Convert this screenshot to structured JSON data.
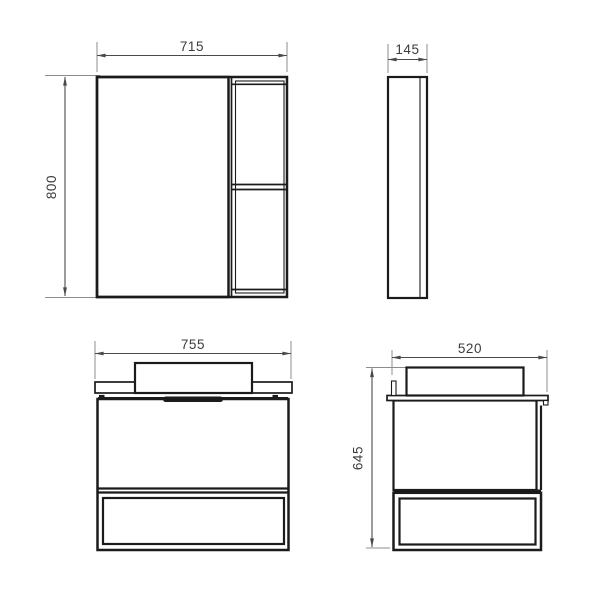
{
  "drawing": {
    "mirror_front": {
      "width": "715",
      "height": "800"
    },
    "mirror_side": {
      "depth": "145"
    },
    "vanity_front": {
      "width": "755"
    },
    "vanity_side": {
      "depth": "520",
      "height": "645"
    }
  },
  "colors": {
    "background": "#ffffff",
    "object_line": "#1b1b1b",
    "dimension_line": "#4a4a4a",
    "extension_line": "#8c8c8c",
    "text": "#3c3c3c"
  }
}
